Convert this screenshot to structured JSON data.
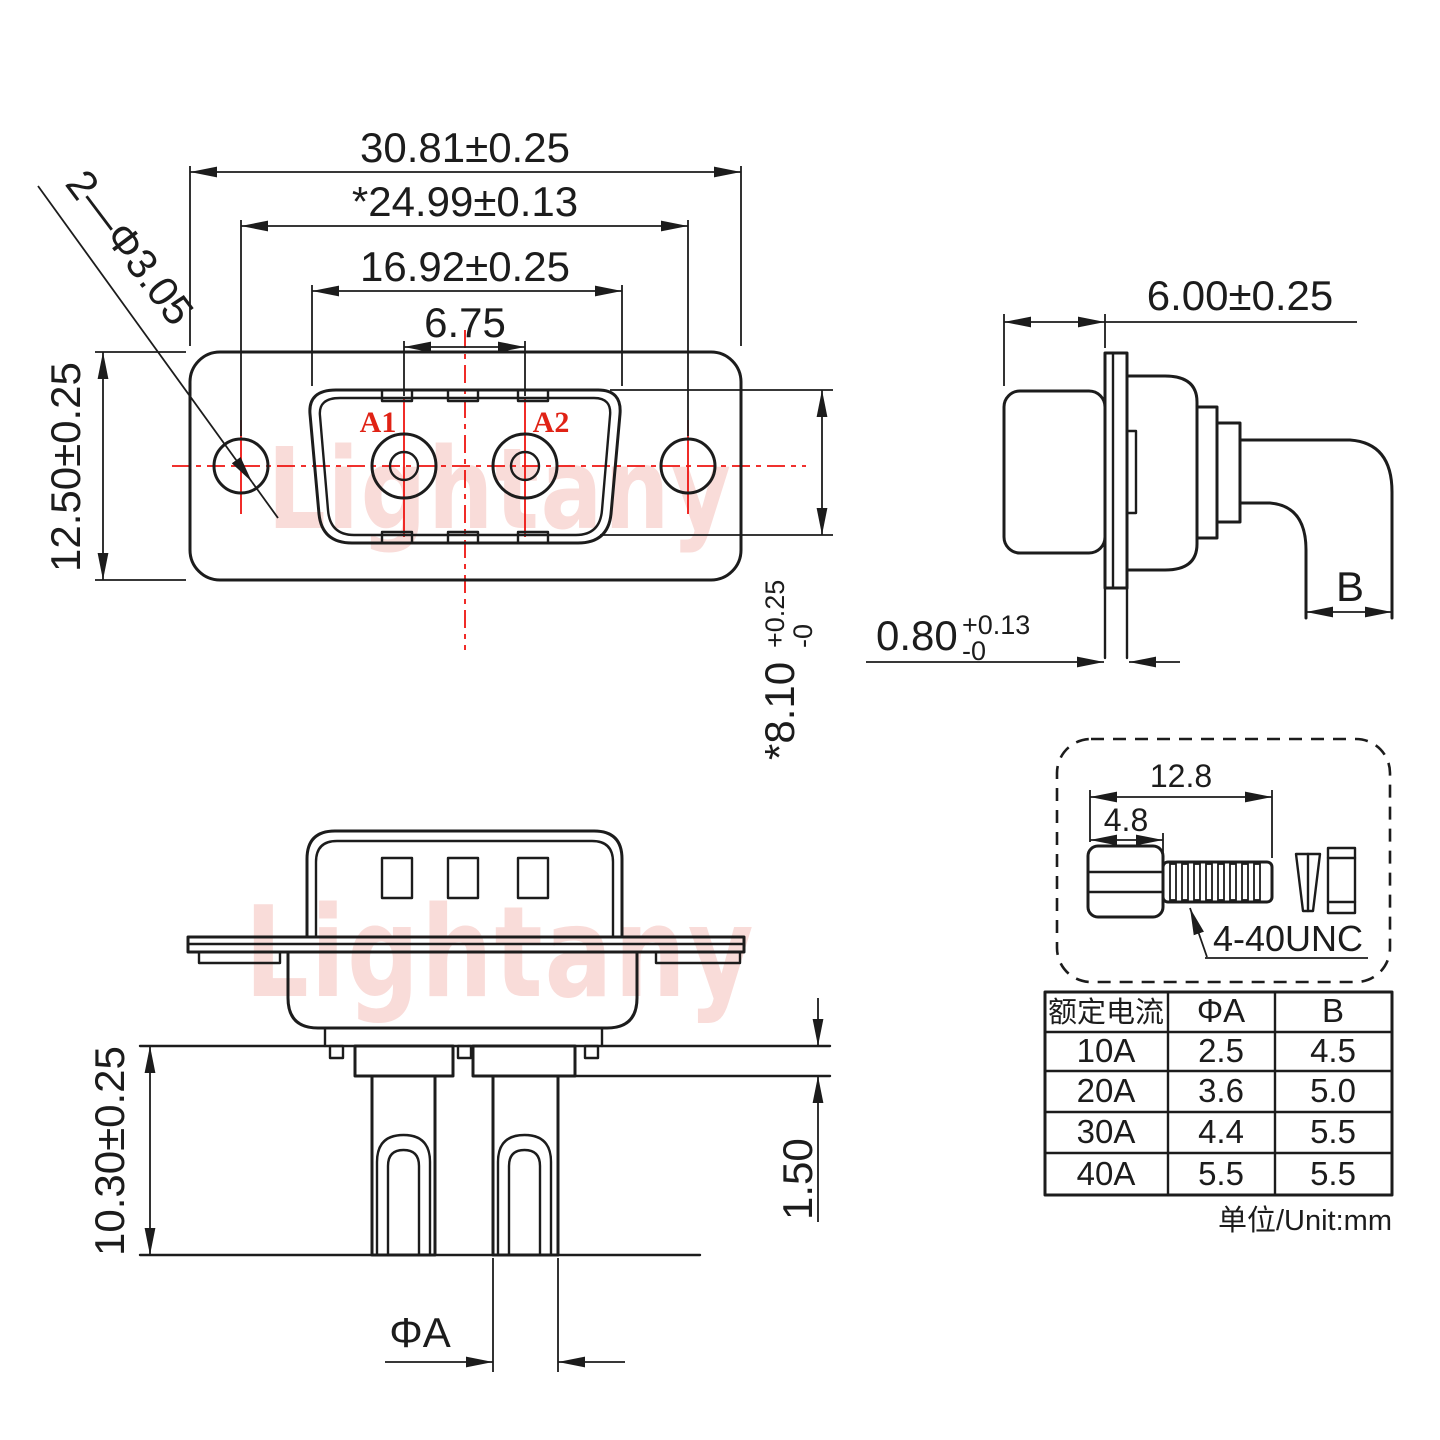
{
  "colors": {
    "line": "#1c1c1c",
    "red": "#ee1411",
    "watermark": "#f9dcd9"
  },
  "watermark": {
    "text": "Lightany"
  },
  "front_view": {
    "dim_outer_width": "30.81±0.25",
    "dim_hole_span": "*24.99±0.13",
    "dim_shell_width": "16.92±0.25",
    "dim_pitch": "6.75",
    "dim_mount_holes": "2—Φ3.05",
    "dim_height": "12.50±0.25",
    "dim_shell_height": {
      "value": "*8.10",
      "plus": "+0.25",
      "minus": "-0"
    },
    "pin_labels": [
      "A1",
      "A2"
    ]
  },
  "side_view": {
    "dim_depth": "6.00±0.25",
    "dim_flange_thickness": {
      "value": "0.80",
      "plus": "+0.13",
      "minus": "-0"
    },
    "dim_tail_width": "B"
  },
  "bottom_view": {
    "dim_pin_length": "10.30±0.25",
    "dim_standoff": "1.50",
    "dim_pin_diameter": "ΦA"
  },
  "screw_detail": {
    "dim_total_length": "12.8",
    "dim_head_length": "4.8",
    "thread_label": "4-40UNC"
  },
  "table": {
    "headers": [
      "额定电流",
      "ΦA",
      "B"
    ],
    "rows": [
      [
        "10A",
        "2.5",
        "4.5"
      ],
      [
        "20A",
        "3.6",
        "5.0"
      ],
      [
        "30A",
        "4.4",
        "5.5"
      ],
      [
        "40A",
        "5.5",
        "5.5"
      ]
    ],
    "unit_note": "单位/Unit:mm"
  }
}
